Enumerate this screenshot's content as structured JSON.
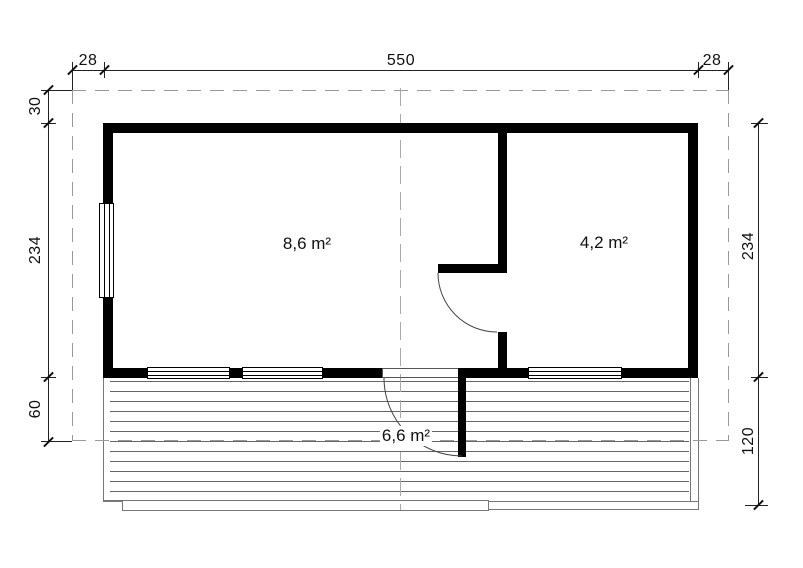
{
  "dimensions": {
    "top": {
      "left_overhang": "28",
      "building_width": "550",
      "right_overhang": "28"
    },
    "left": {
      "roof_overhang": "30",
      "building_depth": "234",
      "terrace_front": "60"
    },
    "right": {
      "building_depth": "234",
      "terrace_depth": "120"
    }
  },
  "rooms": {
    "living": {
      "area": "8,6 m²"
    },
    "side_room": {
      "area": "4,2 m²"
    },
    "terrace": {
      "area": "6,6 m²"
    }
  },
  "colors": {
    "wall": "#000000",
    "dimension_line": "#222222",
    "roof_dash": "#999999",
    "deck_line": "#666666",
    "background": "#ffffff"
  }
}
